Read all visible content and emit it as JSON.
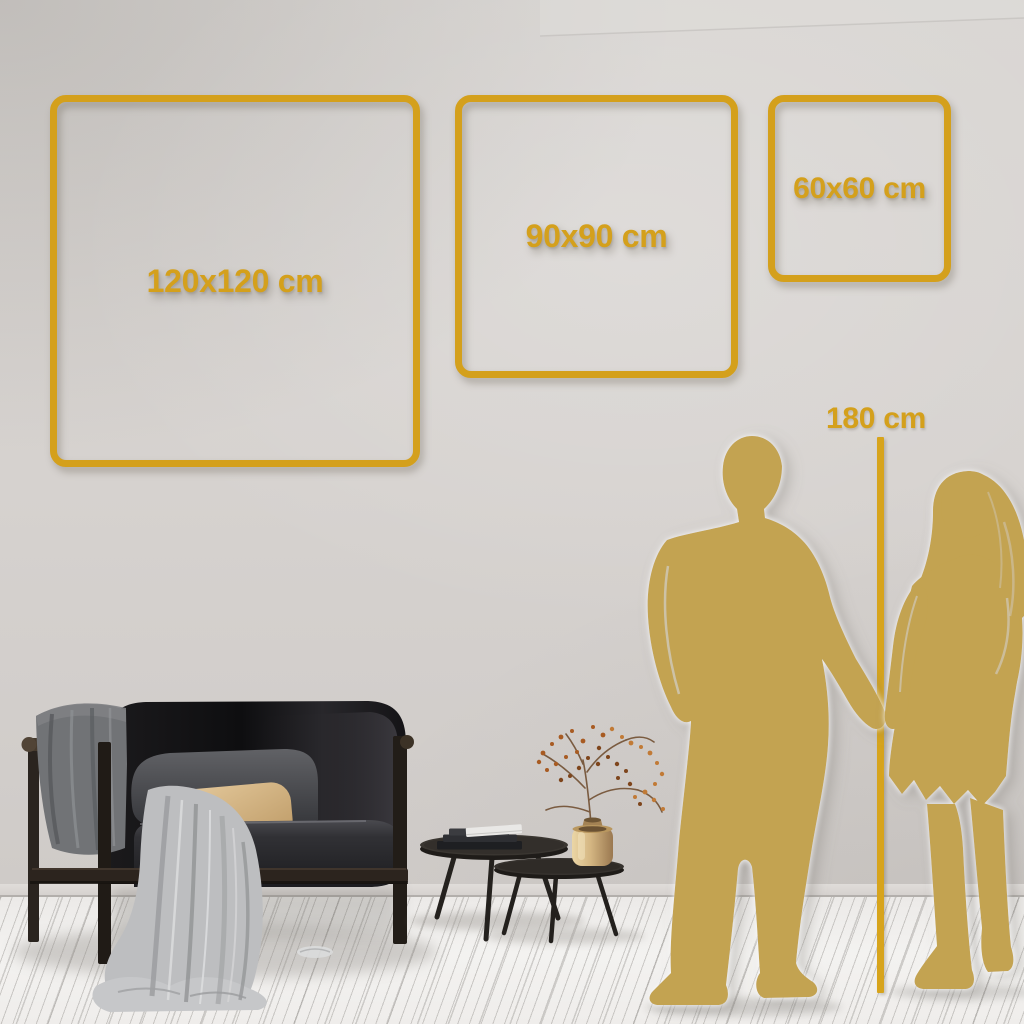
{
  "size_guide": {
    "frames": [
      {
        "label": "120x120 cm",
        "width_cm": 120,
        "height_cm": 120
      },
      {
        "label": "90x90 cm",
        "width_cm": 90,
        "height_cm": 90
      },
      {
        "label": "60x60 cm",
        "width_cm": 60,
        "height_cm": 60
      }
    ],
    "height_reference": {
      "label": "180 cm",
      "height_cm": 180
    }
  },
  "scene": {
    "accent_gold": "#D4A01C",
    "line_gold": "#D7A41E",
    "silhouette_gold": "#C3A351",
    "wall_color": "#D6D2CF",
    "floor_color": "#F0EFED",
    "icons": [
      "man-silhouette",
      "woman-silhouette",
      "sofa",
      "blanket",
      "cushion",
      "coffee-tables",
      "books",
      "vase-with-branches",
      "height-reference-line"
    ]
  }
}
